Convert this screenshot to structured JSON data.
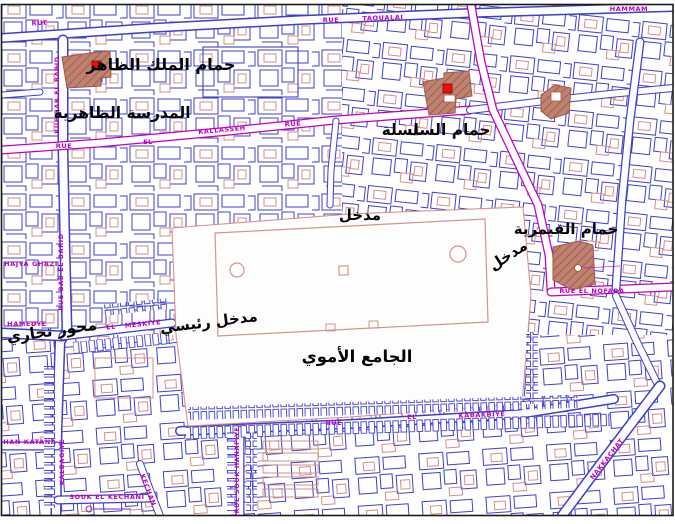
{
  "map": {
    "colors": {
      "background": "#fdfdfe",
      "building_outline_blue": "#3f3fca",
      "parcel_salmon": "#d19086",
      "street_label_magenta": "#c000c0",
      "street_edge_magenta": "#c000c0",
      "hammam_fill_brown": "#bf8170",
      "hammam_hatch": "#9a5a49",
      "marker_red": "#e81010",
      "frame_black": "#1a1a1a",
      "scale_purple": "#7a2ea0"
    },
    "site_labels": [
      {
        "id": "hammam-zahir",
        "text": "حمام الملك الظاهر"
      },
      {
        "id": "madrasa-zahiriya",
        "text": "المدرسة الظاهرية"
      },
      {
        "id": "hammam-silsila",
        "text": "حمام السلسلة"
      },
      {
        "id": "hammam-qaymariya",
        "text": "حمام القيمرية"
      },
      {
        "id": "entrance-north",
        "text": "مدخل"
      },
      {
        "id": "entrance-east",
        "text": "مدخل"
      },
      {
        "id": "entrance-main",
        "text": "مدخل رئيسي"
      },
      {
        "id": "commercial-axis",
        "text": "محور تجاري"
      },
      {
        "id": "umayyad-mosque",
        "text": "الجامع الأموي"
      }
    ],
    "street_labels": [
      {
        "id": "rue-top-left",
        "text": "RUE"
      },
      {
        "id": "rue-top-mid",
        "text": "RUE"
      },
      {
        "id": "taoualai",
        "text": "TAOUALAI"
      },
      {
        "id": "hammam-top-right",
        "text": "HAMMAM"
      },
      {
        "id": "bab-el-barid-upper",
        "text": "RUE BAB EL BARID"
      },
      {
        "id": "bab-el-barid-lower",
        "text": "RUE BAB EL BARID"
      },
      {
        "id": "rue-kallasseh-west",
        "text": "RUE"
      },
      {
        "id": "el-kallasseh",
        "text": "EL"
      },
      {
        "id": "kallasseh",
        "text": "KALLASSEH"
      },
      {
        "id": "rue-kallasseh-east",
        "text": "RUE"
      },
      {
        "id": "hajya-ghazi",
        "text": "HAJYA GHAZI"
      },
      {
        "id": "hamedye",
        "text": "HAMEDYE"
      },
      {
        "id": "meskiye-el",
        "text": "EL"
      },
      {
        "id": "meskiye",
        "text": "MESKIYE"
      },
      {
        "id": "khan-katana",
        "text": "KHAN KATANA"
      },
      {
        "id": "kalbagiye",
        "text": "KALBAGIYE"
      },
      {
        "id": "souk-el-kechani",
        "text": "SOUK EL KECHANI"
      },
      {
        "id": "kechan",
        "text": "KECHAN"
      },
      {
        "id": "rue-souk-hanafiye",
        "text": "RUE SOUK HANAFIYE"
      },
      {
        "id": "rue-kabakbiye",
        "text": "RUE"
      },
      {
        "id": "el-kabakbiye",
        "text": "EL"
      },
      {
        "id": "kabakbiye",
        "text": "KABAKBIYE"
      },
      {
        "id": "rue-el-nofara",
        "text": "RUE  EL  NOFARA"
      },
      {
        "id": "nakkachat",
        "text": "NAKKACHAT"
      }
    ]
  }
}
